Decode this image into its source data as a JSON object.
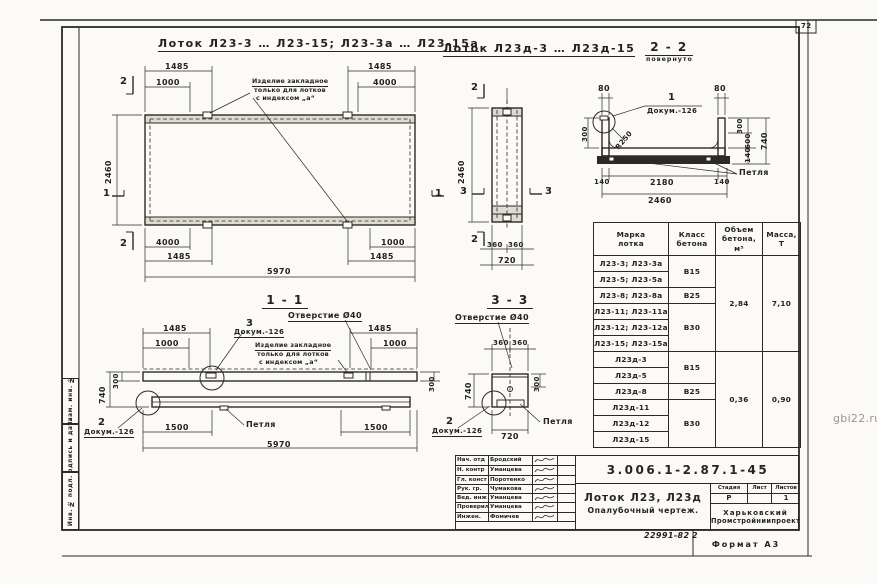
{
  "page": {
    "sheet_number": "72",
    "watermark": "gbi22.ru",
    "order_number": "22991-82",
    "order_sheet": "2",
    "format_label": "Формат А3"
  },
  "titles": {
    "main_left": "Лоток Л23-3 … Л23-15; Л23-3а … Л23-15а",
    "main_middle": "Лоток Л23д-3 … Л23д-15",
    "section_2_2": "2 - 2",
    "section_2_2_note": "повернуто",
    "section_1_1": "1 - 1",
    "section_3_3": "3 - 3"
  },
  "shared": {
    "loop_label": "Петля",
    "doc_ref": "Докум.-126",
    "hole_label": "Отверстие Ø40",
    "detail_1": "1",
    "detail_2": "2",
    "detail_3": "3",
    "note_line1": "Изделие закладное",
    "note_line2": "только для лотков",
    "note_line3": "с индексом „а“"
  },
  "plan_view": {
    "dim_1485_tl": "1485",
    "dim_1000_tl": "1000",
    "dim_1485_tr": "1485",
    "dim_4000_tr": "4000",
    "dim_2460_left": "2460",
    "dim_4000_bl": "4000",
    "dim_1485_bl": "1485",
    "dim_1000_br": "1000",
    "dim_1485_br": "1485",
    "dim_5970": "5970",
    "mark_2_top": "2",
    "mark_2_bottom": "2",
    "mark_1_left": "1",
    "mark_1_right": "1"
  },
  "narrow_view": {
    "dim_2460": "2460",
    "dim_360_l": "360",
    "dim_360_r": "360",
    "dim_720": "720",
    "mark_2_top": "2",
    "mark_2_bottom": "2",
    "mark_3_left": "3",
    "mark_3_right": "3"
  },
  "section22": {
    "dim_80_l": "80",
    "dim_80_r": "80",
    "radius": "R250",
    "dim_300_left": "300",
    "dim_300_r": "300",
    "dim_600_r": "600",
    "dim_140_r": "140",
    "dim_740_r": "740",
    "dim_140_bl": "140",
    "dim_2180": "2180",
    "dim_140_br": "140",
    "dim_2460": "2460"
  },
  "section11": {
    "dim_1485_l": "1485",
    "dim_1000_l": "1000",
    "dim_1485_r": "1485",
    "dim_1000_r": "1000",
    "dim_300_l": "300",
    "dim_740_l": "740",
    "dim_300_r": "300",
    "dim_1500_l": "1500",
    "dim_1500_r": "1500",
    "dim_5970": "5970"
  },
  "section33": {
    "dim_360_l": "360",
    "dim_360_r": "360",
    "dim_740": "740",
    "dim_300_r": "300",
    "dim_720": "720"
  },
  "table": {
    "header_mark": "Марка\nлотка",
    "header_class": "Класс\nбетона",
    "header_volume": "Объем\nбетона,\nм³",
    "header_mass": "Масса,\nТ",
    "rows": [
      {
        "mark": "Л23-3; Л23-3а"
      },
      {
        "mark": "Л23-5; Л23-5а"
      },
      {
        "mark": "Л23-8; Л23-8а"
      },
      {
        "mark": "Л23-11; Л23-11а"
      },
      {
        "mark": "Л23-12; Л23-12а"
      },
      {
        "mark": "Л23-15; Л23-15а"
      },
      {
        "mark": "Л23д-3"
      },
      {
        "mark": "Л23д-5"
      },
      {
        "mark": "Л23д-8"
      },
      {
        "mark": "Л23д-11"
      },
      {
        "mark": "Л23д-12"
      },
      {
        "mark": "Л23д-15"
      }
    ],
    "class_b15_1": "В15",
    "class_b25_1": "В25",
    "class_b30_1": "В30",
    "class_b15_2": "В15",
    "class_b25_2": "В25",
    "class_b30_2": "В30",
    "volume_1": "2,84",
    "mass_1": "7,10",
    "volume_2": "0,36",
    "mass_2": "0,90"
  },
  "titleblock": {
    "doc_number": "3.006.1-2.87.1-45",
    "signature_rows": [
      {
        "role": "Нач. отд",
        "name": "Бродский"
      },
      {
        "role": "Н. контр",
        "name": "Уманцева"
      },
      {
        "role": "Гл. конст",
        "name": "Поротенко"
      },
      {
        "role": "Рук. гр.",
        "name": "Чумакова"
      },
      {
        "role": "Вед. инж",
        "name": "Уманцева"
      },
      {
        "role": "Проверил",
        "name": "Уманцева"
      },
      {
        "role": "Инжен.",
        "name": "Фомичев"
      }
    ],
    "title_line1": "Лоток Л23, Л23д",
    "title_line2": "Опалубочный чертеж.",
    "stage_label": "Стадия",
    "sheet_label": "Лист",
    "sheets_label": "Листов",
    "stage_value": "Р",
    "sheet_value": "",
    "sheets_value": "1",
    "org_line1": "Харьковский",
    "org_line2": "Промстройниипроект"
  },
  "stamps": {
    "s1": "Взам. инв. №",
    "s2": "Подпись и дата",
    "s3": "Инв. № подл."
  }
}
